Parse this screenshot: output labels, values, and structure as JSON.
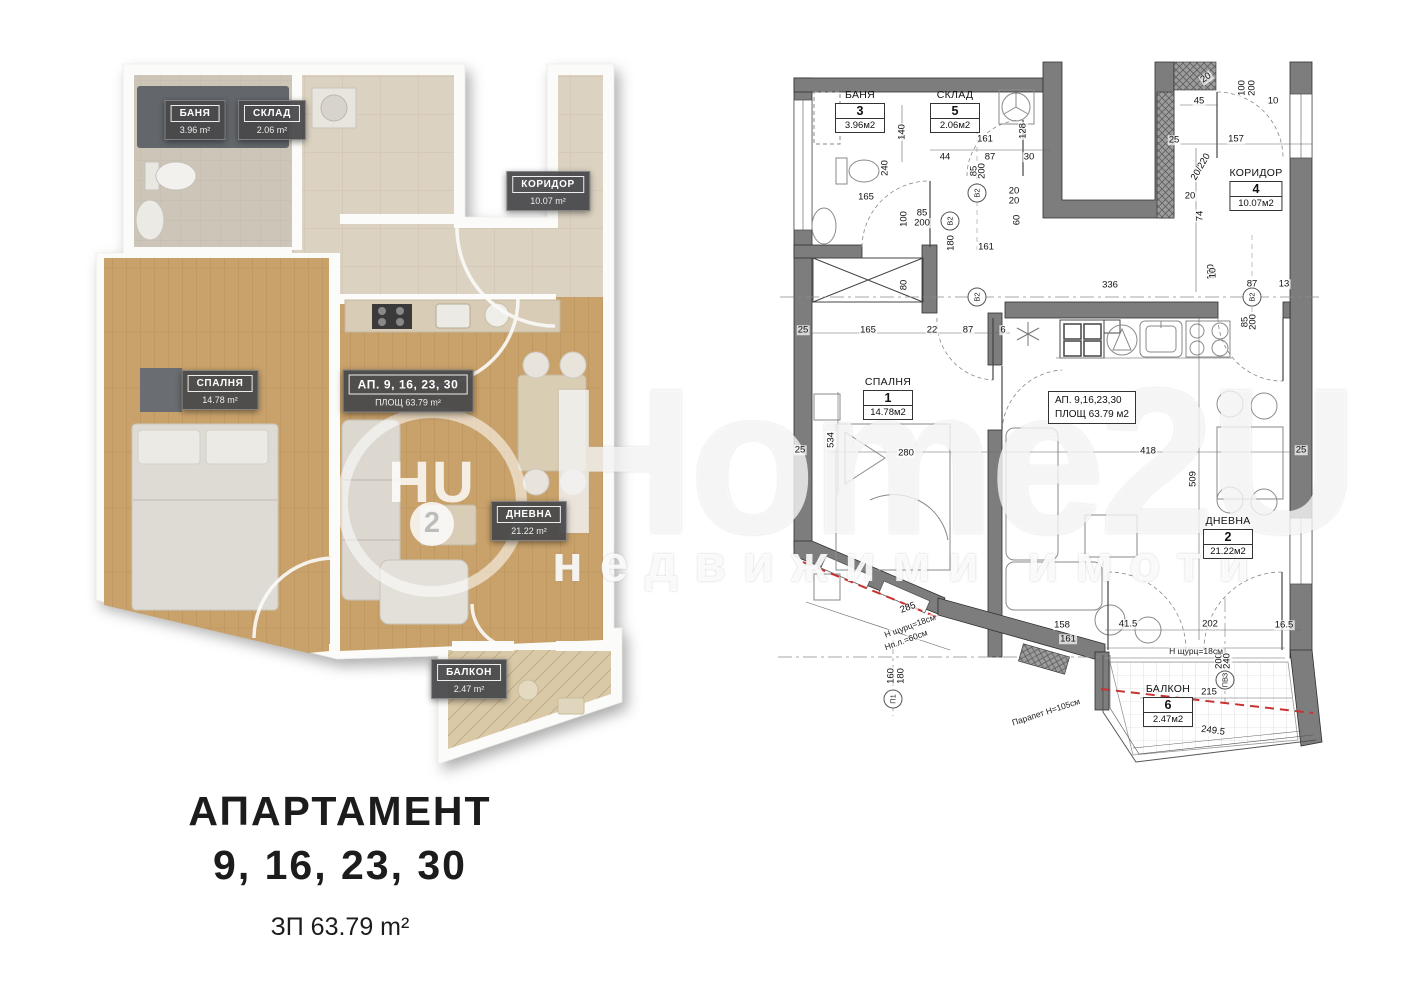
{
  "caption": {
    "title": "АПАРТАМЕНТ",
    "numbers": "9, 16, 23, 30",
    "built_area": "ЗП 63.79 m²"
  },
  "watermark": {
    "logo_main": "HU",
    "logo_digit": "2",
    "brand": "Home2U",
    "tagline": "недвижими имоти"
  },
  "render_plan": {
    "rooms": [
      {
        "name": "БАНЯ",
        "area": "3.96 m²"
      },
      {
        "name": "СКЛАД",
        "area": "2.06 m²"
      },
      {
        "name": "КОРИДОР",
        "area": "10.07 m²"
      },
      {
        "name": "СПАЛНЯ",
        "area": "14.78 m²"
      },
      {
        "name": "АП. 9, 16, 23, 30",
        "area": "ПЛОЩ 63.79 m²"
      },
      {
        "name": "ДНЕВНА",
        "area": "21.22 m²"
      },
      {
        "name": "БАЛКОН",
        "area": "2.47 m²"
      }
    ]
  },
  "tech_plan": {
    "apartment_box": {
      "line1": "АП.  9,16,23,30",
      "line2": "ПЛОЩ 63.79 м2"
    },
    "rooms": [
      {
        "name": "БАНЯ",
        "number": "3",
        "area": "3.96м2"
      },
      {
        "name": "СКЛАД",
        "number": "5",
        "area": "2.06м2"
      },
      {
        "name": "КОРИДОР",
        "number": "4",
        "area": "10.07м2"
      },
      {
        "name": "СПАЛНЯ",
        "number": "1",
        "area": "14.78м2"
      },
      {
        "name": "ДНЕВНА",
        "number": "2",
        "area": "21.22м2"
      },
      {
        "name": "БАЛКОН",
        "number": "6",
        "area": "2.47м2"
      }
    ],
    "dimensions": [
      {
        "t": "140",
        "x": 902,
        "y": 132,
        "r": -90
      },
      {
        "t": "240",
        "x": 885,
        "y": 168,
        "r": -90
      },
      {
        "t": "165",
        "x": 866,
        "y": 197
      },
      {
        "t": "100",
        "x": 904,
        "y": 219,
        "r": -90
      },
      {
        "t": "85",
        "x": 922,
        "y": 213
      },
      {
        "t": "200",
        "x": 922,
        "y": 223
      },
      {
        "t": "180",
        "x": 951,
        "y": 243,
        "r": -90
      },
      {
        "t": "44",
        "x": 945,
        "y": 157
      },
      {
        "t": "87",
        "x": 990,
        "y": 157
      },
      {
        "t": "30",
        "x": 1029,
        "y": 157
      },
      {
        "t": "161",
        "x": 985,
        "y": 139
      },
      {
        "t": "161",
        "x": 986,
        "y": 247
      },
      {
        "t": "128",
        "x": 1023,
        "y": 131,
        "r": -90
      },
      {
        "t": "85",
        "x": 974,
        "y": 171,
        "r": -90
      },
      {
        "t": "200",
        "x": 982,
        "y": 171,
        "r": -90
      },
      {
        "t": "20",
        "x": 1014,
        "y": 191
      },
      {
        "t": "20",
        "x": 1014,
        "y": 201
      },
      {
        "t": "60",
        "x": 1017,
        "y": 220,
        "r": -90
      },
      {
        "t": "20",
        "x": 1206,
        "y": 78,
        "r": -35
      },
      {
        "t": "45",
        "x": 1199,
        "y": 101
      },
      {
        "t": "100",
        "x": 1242,
        "y": 88,
        "r": -90
      },
      {
        "t": "200",
        "x": 1252,
        "y": 88,
        "r": -90
      },
      {
        "t": "10",
        "x": 1273,
        "y": 101
      },
      {
        "t": "25",
        "x": 1174,
        "y": 140
      },
      {
        "t": "157",
        "x": 1236,
        "y": 139
      },
      {
        "t": "20/220",
        "x": 1201,
        "y": 167,
        "r": -60
      },
      {
        "t": "20",
        "x": 1190,
        "y": 196
      },
      {
        "t": "74",
        "x": 1200,
        "y": 216,
        "r": -90
      },
      {
        "t": "100",
        "x": 1211,
        "y": 272,
        "r": -90
      },
      {
        "t": "87",
        "x": 1252,
        "y": 284
      },
      {
        "t": "13",
        "x": 1284,
        "y": 284
      },
      {
        "t": "336",
        "x": 1110,
        "y": 285
      },
      {
        "t": "10",
        "x": 1213,
        "y": 273,
        "r": -90
      },
      {
        "t": "85",
        "x": 1245,
        "y": 322,
        "r": -90
      },
      {
        "t": "200",
        "x": 1253,
        "y": 322,
        "r": -90
      },
      {
        "t": "80",
        "x": 904,
        "y": 285,
        "r": -90
      },
      {
        "t": "25",
        "x": 803,
        "y": 330
      },
      {
        "t": "165",
        "x": 868,
        "y": 330
      },
      {
        "t": "22",
        "x": 932,
        "y": 330
      },
      {
        "t": "87",
        "x": 968,
        "y": 330
      },
      {
        "t": "6",
        "x": 1003,
        "y": 330
      },
      {
        "t": "25",
        "x": 800,
        "y": 450
      },
      {
        "t": "25",
        "x": 1301,
        "y": 450
      },
      {
        "t": "534",
        "x": 831,
        "y": 440,
        "r": -90
      },
      {
        "t": "280",
        "x": 906,
        "y": 453
      },
      {
        "t": "418",
        "x": 1148,
        "y": 451
      },
      {
        "t": "509",
        "x": 1193,
        "y": 479,
        "r": -90
      },
      {
        "t": "285",
        "x": 908,
        "y": 608,
        "r": -20
      },
      {
        "t": "158",
        "x": 1062,
        "y": 625
      },
      {
        "t": "161",
        "x": 1068,
        "y": 639
      },
      {
        "t": "160",
        "x": 891,
        "y": 676,
        "r": -90
      },
      {
        "t": "180",
        "x": 901,
        "y": 676,
        "r": -90
      },
      {
        "t": "41.5",
        "x": 1128,
        "y": 624
      },
      {
        "t": "202",
        "x": 1210,
        "y": 624
      },
      {
        "t": "16.5",
        "x": 1284,
        "y": 625
      },
      {
        "t": "200",
        "x": 1219,
        "y": 661,
        "r": -90
      },
      {
        "t": "240",
        "x": 1227,
        "y": 661,
        "r": -90
      },
      {
        "t": "215",
        "x": 1209,
        "y": 692
      },
      {
        "t": "249.5",
        "x": 1213,
        "y": 731,
        "r": 8
      }
    ],
    "annotations": [
      {
        "t": "Н щурц=18см",
        "x": 910,
        "y": 626,
        "r": -20
      },
      {
        "t": "Нп.л.=60см",
        "x": 906,
        "y": 640,
        "r": -20
      },
      {
        "t": "Н щурц=18см",
        "x": 1196,
        "y": 651
      },
      {
        "t": "Парапет Н=105см",
        "x": 1046,
        "y": 712,
        "r": -18
      }
    ],
    "markers": [
      {
        "t": "B2",
        "x": 977,
        "y": 193,
        "r": -90
      },
      {
        "t": "B2",
        "x": 950,
        "y": 221,
        "r": -90
      },
      {
        "t": "B2",
        "x": 977,
        "y": 297,
        "r": -90
      },
      {
        "t": "B2",
        "x": 1252,
        "y": 297,
        "r": -90
      },
      {
        "t": "П1",
        "x": 893,
        "y": 699,
        "r": -90
      },
      {
        "t": "ПВЗ",
        "x": 1225,
        "y": 680,
        "r": -90
      }
    ]
  },
  "colors": {
    "render_wall": "#fbfbf9",
    "wood": "#c9a26b",
    "tile": "#dcd2c1",
    "tech_wall": "#7d7d7d",
    "red_dashed": "#c83232",
    "badge_bg": "#48484b"
  }
}
